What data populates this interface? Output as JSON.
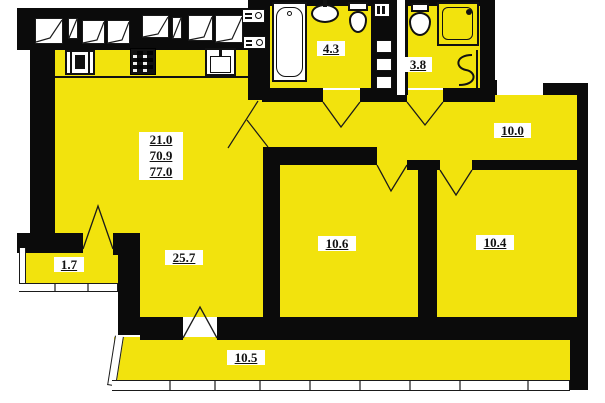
{
  "plan": {
    "kind": "apartment floor plan",
    "colors": {
      "room_fill": "#F2E30D",
      "wall": "#0B0B0B",
      "label_bg": "#FFFFFF",
      "label_text": "#111111",
      "outside": "#FFFFFF"
    },
    "totals": {
      "line1": "21.0",
      "line2": "70.9",
      "line3": "77.0"
    },
    "rooms": {
      "living": {
        "label": "25.7"
      },
      "bedroom_middle": {
        "label": "10.6"
      },
      "bedroom_right": {
        "label": "10.4"
      },
      "hallway": {
        "label": "10.0"
      },
      "bathroom": {
        "label": "4.3"
      },
      "toilet_room": {
        "label": "3.8"
      },
      "balcony_small": {
        "label": "1.7"
      },
      "balcony_long": {
        "label": "10.5"
      }
    },
    "icons": {
      "bathtub": "bathtub-icon",
      "washbasin": "washbasin-icon",
      "toilet": "toilet-icon",
      "shower_cabin": "shower-cabin-icon",
      "towel_rail": "towel-rail-icon",
      "ventilation_shaft": "ventilation-shaft-icon",
      "kitchen_stove": "kitchen-stove-icon",
      "cooktop": "cooktop-icon",
      "kitchen_sink": "kitchen-sink-icon",
      "electric_meter": "electric-meter-icon",
      "window": "window-icon",
      "door": "door-swing-icon"
    }
  }
}
